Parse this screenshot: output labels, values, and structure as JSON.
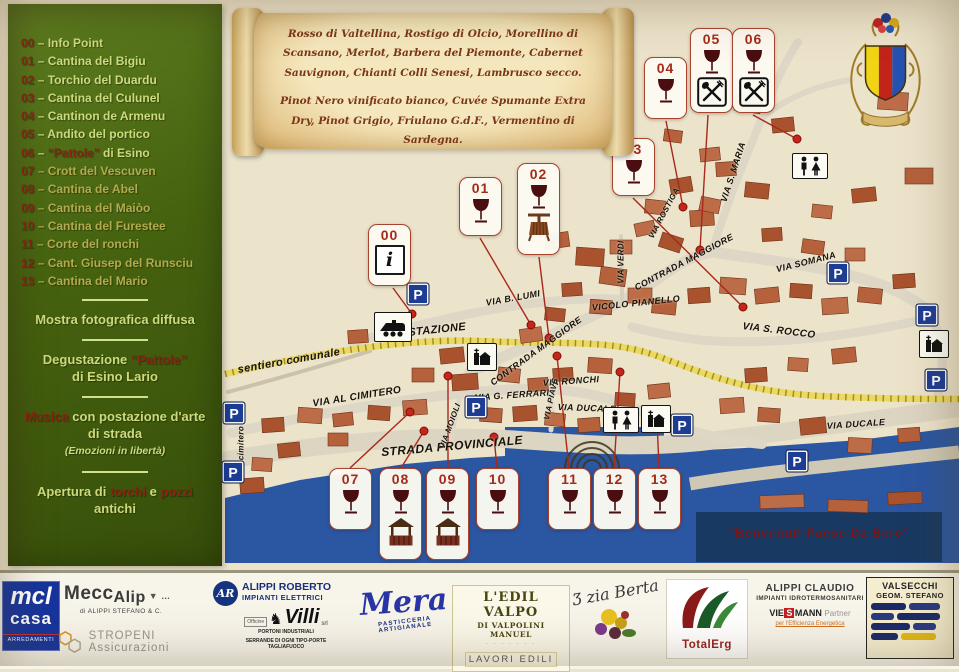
{
  "legend": {
    "sep": "–",
    "items": [
      {
        "num": "00",
        "parts": [
          {
            "t": "Info Point",
            "red": false
          }
        ]
      },
      {
        "num": "01",
        "parts": [
          {
            "t": "Cantina del Bigiu",
            "red": false
          }
        ]
      },
      {
        "num": "02",
        "parts": [
          {
            "t": "Torchio del Duardu",
            "red": false
          }
        ]
      },
      {
        "num": "03",
        "parts": [
          {
            "t": "Cantina del Culunel",
            "red": false
          }
        ]
      },
      {
        "num": "04",
        "parts": [
          {
            "t": "Cantinon de Armenu",
            "red": false
          }
        ]
      },
      {
        "num": "05",
        "parts": [
          {
            "t": "Andito del portico",
            "red": false
          }
        ]
      },
      {
        "num": "06",
        "parts": [
          {
            "t": "“Pattole”",
            "red": true
          },
          {
            "t": " di Esino",
            "red": false
          }
        ]
      },
      {
        "num": "07",
        "parts": [
          {
            "t": "Crott del Vescuven",
            "red": false
          }
        ]
      },
      {
        "num": "08",
        "parts": [
          {
            "t": "Cantina de Abel",
            "red": false
          }
        ]
      },
      {
        "num": "09",
        "parts": [
          {
            "t": "Cantina del Maiòo",
            "red": false
          }
        ]
      },
      {
        "num": "10",
        "parts": [
          {
            "t": "Cantina del Furestee",
            "red": false
          }
        ]
      },
      {
        "num": "11",
        "parts": [
          {
            "t": "Corte del ronchi",
            "red": false
          }
        ]
      },
      {
        "num": "12",
        "parts": [
          {
            "t": "Cant. Giusep del Runsciu",
            "red": false
          }
        ]
      },
      {
        "num": "13",
        "parts": [
          {
            "t": "Cantina del Mario",
            "red": false
          }
        ]
      }
    ],
    "notes": [
      {
        "lines": [
          [
            {
              "t": "Mostra fotografica diffusa",
              "red": false
            }
          ]
        ]
      },
      {
        "lines": [
          [
            {
              "t": "Degustazione ",
              "red": false
            },
            {
              "t": "“Pattole”",
              "red": true
            }
          ],
          [
            {
              "t": "di Esino Lario",
              "red": false
            }
          ]
        ]
      },
      {
        "lines": [
          [
            {
              "t": "Musica",
              "red": true
            },
            {
              "t": " con postazione d'arte",
              "red": false
            }
          ],
          [
            {
              "t": "di strada",
              "red": false
            }
          ]
        ],
        "sub": "(Emozioni in libertà)"
      },
      {
        "lines": [
          [
            {
              "t": "Apertura di ",
              "red": false
            },
            {
              "t": "torchi",
              "red": true
            },
            {
              "t": " e ",
              "red": false
            },
            {
              "t": "pozzi",
              "red": true
            }
          ],
          [
            {
              "t": "antichi",
              "red": false
            }
          ]
        ]
      }
    ]
  },
  "scroll": {
    "para1": "Rosso di Valtellina, Rostigo di Olcio, Morellino di Scansano, Merlot, Barbera del Piemonte, Cabernet Sauvignon, Chianti Colli Senesi, Lambrusco secco.",
    "para2": "Pinot Nero vinificato bianco, Cuvée Spumante Extra Dry, Pinot Grigio, Friulano G.d.F., Vermentino di Sardegna."
  },
  "map": {
    "welcome": "“Benvenuti Paese Da Bere”",
    "parking_label": "P",
    "info_symbol": "i",
    "markers": [
      {
        "num": "00",
        "icon": "info",
        "x": 368,
        "y": 224,
        "h": 62,
        "line": [
          393,
          288,
          412,
          314
        ]
      },
      {
        "num": "01",
        "icon": "wine",
        "x": 459,
        "y": 177,
        "h": 59,
        "line": [
          480,
          238,
          531,
          325
        ]
      },
      {
        "num": "02",
        "icon": "wine",
        "extra": "press",
        "x": 517,
        "y": 163,
        "h": 92,
        "line": [
          539,
          257,
          549,
          338
        ]
      },
      {
        "num": "03",
        "icon": "wine",
        "x": 612,
        "y": 138,
        "h": 58,
        "line": [
          633,
          198,
          743,
          307
        ]
      },
      {
        "num": "04",
        "icon": "wine",
        "x": 644,
        "y": 57,
        "h": 62,
        "line": [
          666,
          121,
          683,
          207
        ]
      },
      {
        "num": "05",
        "icon": "wine",
        "extra": "cutlery",
        "x": 690,
        "y": 28,
        "h": 85,
        "line": [
          708,
          115,
          700,
          250
        ]
      },
      {
        "num": "06",
        "icon": "wine",
        "extra": "cutlery",
        "x": 732,
        "y": 28,
        "h": 85,
        "line": [
          753,
          115,
          797,
          139
        ]
      },
      {
        "num": "07",
        "icon": "wine",
        "x": 329,
        "y": 468,
        "h": 62,
        "line": [
          350,
          468,
          410,
          412
        ]
      },
      {
        "num": "08",
        "icon": "wine",
        "extra": "well",
        "x": 379,
        "y": 468,
        "h": 92,
        "line": [
          401,
          468,
          424,
          431
        ]
      },
      {
        "num": "09",
        "icon": "wine",
        "extra": "well",
        "x": 426,
        "y": 468,
        "h": 92,
        "line": [
          448,
          468,
          448,
          376
        ]
      },
      {
        "num": "10",
        "icon": "wine",
        "x": 476,
        "y": 468,
        "h": 62,
        "line": [
          497,
          468,
          494,
          437
        ]
      },
      {
        "num": "11",
        "icon": "wine",
        "x": 548,
        "y": 468,
        "h": 62,
        "line": [
          569,
          468,
          557,
          356
        ]
      },
      {
        "num": "12",
        "icon": "wine",
        "x": 593,
        "y": 468,
        "h": 62,
        "line": [
          614,
          468,
          620,
          372
        ]
      },
      {
        "num": "13",
        "icon": "wine",
        "x": 638,
        "y": 468,
        "h": 62,
        "line": [
          659,
          468,
          657,
          420
        ]
      }
    ],
    "streets": [
      {
        "t": "VIA STAZIONE",
        "x": 426,
        "y": 331,
        "r": -6,
        "s": 11
      },
      {
        "t": "VIA B. LUMI",
        "x": 513,
        "y": 298,
        "r": -10,
        "s": 9
      },
      {
        "t": "CONTRADA MAGGIORE",
        "x": 536,
        "y": 351,
        "r": -36,
        "s": 9
      },
      {
        "t": "VICOLO PIANELLO",
        "x": 636,
        "y": 303,
        "r": -6,
        "s": 9
      },
      {
        "t": "CONTRADA MAGGIORE",
        "x": 684,
        "y": 262,
        "r": -28,
        "s": 9
      },
      {
        "t": "VIA SOMANA",
        "x": 806,
        "y": 262,
        "r": -14,
        "s": 9
      },
      {
        "t": "VIA S. ROCCO",
        "x": 779,
        "y": 331,
        "r": 7,
        "s": 10
      },
      {
        "t": "VIA VERDI",
        "x": 621,
        "y": 262,
        "r": -90,
        "s": 8
      },
      {
        "t": "VIA ROSTIGA",
        "x": 664,
        "y": 213,
        "r": -62,
        "s": 8
      },
      {
        "t": "VIA S. MARIA",
        "x": 733,
        "y": 172,
        "r": -72,
        "s": 9
      },
      {
        "t": "sentiero comunale",
        "x": 289,
        "y": 361,
        "r": -10,
        "s": 11
      },
      {
        "t": "VIA AL CIMITERO",
        "x": 357,
        "y": 397,
        "r": -9,
        "s": 10
      },
      {
        "t": "cimitero",
        "x": 241,
        "y": 443,
        "r": -90,
        "s": 8
      },
      {
        "t": "STRADA PROVINCIALE",
        "x": 452,
        "y": 446,
        "r": -5,
        "s": 12
      },
      {
        "t": "VIA MOIOLI",
        "x": 450,
        "y": 426,
        "r": -70,
        "s": 8
      },
      {
        "t": "VIA G. FERRARI",
        "x": 512,
        "y": 395,
        "r": -4,
        "s": 9
      },
      {
        "t": "VIA RONCHI",
        "x": 571,
        "y": 381,
        "r": -4,
        "s": 9
      },
      {
        "t": "VIA PIAVE",
        "x": 551,
        "y": 399,
        "r": -78,
        "s": 8
      },
      {
        "t": "VIA DUCALE",
        "x": 587,
        "y": 408,
        "r": 2,
        "s": 9
      },
      {
        "t": "VIA DUCALE",
        "x": 856,
        "y": 424,
        "r": -4,
        "s": 9
      }
    ],
    "parkings": [
      [
        418,
        294
      ],
      [
        234,
        413
      ],
      [
        233,
        472
      ],
      [
        476,
        407
      ],
      [
        838,
        273
      ],
      [
        927,
        315
      ],
      [
        936,
        380
      ],
      [
        797,
        461
      ],
      [
        682,
        425
      ]
    ],
    "pois": [
      {
        "type": "train",
        "x": 393,
        "y": 327
      },
      {
        "type": "church",
        "x": 482,
        "y": 357
      },
      {
        "type": "church",
        "x": 656,
        "y": 419
      },
      {
        "type": "church",
        "x": 934,
        "y": 344
      },
      {
        "type": "wc",
        "x": 810,
        "y": 166
      },
      {
        "type": "wc",
        "x": 621,
        "y": 420
      }
    ]
  },
  "sponsors": {
    "mcl": {
      "l1": "mcl",
      "l2": "casa",
      "l3": "ARREDAMENTI"
    },
    "meccalip": {
      "n1": "Mecc",
      "n2": "Alip",
      "deco": "▼ …",
      "sub": "di ALIPPI STEFANO & C."
    },
    "stropeni": {
      "name": "STROPENI Assicurazioni"
    },
    "alippi_roberto": {
      "logo": "AR",
      "l1": "ALIPPI ROBERTO",
      "l2": "IMPIANTI ELETTRICI"
    },
    "villi": {
      "pre": "Officine",
      "name": "Villi",
      "post": "srl",
      "sub1": "PORTONI INDUSTRIALI",
      "sub2": "SERRANDE DI OGNI TIPO-PORTE TAGLIAFUOCO"
    },
    "mera": {
      "name": "Mera",
      "sub": "PASTICCERIA ARTIGIANALE"
    },
    "edilvalpo": {
      "l1": "L'EDIL VALPO",
      "l2": "DI VALPOLINI MANUEL",
      "dots": "· · · · · · ·",
      "l3": "LAVORI EDILI"
    },
    "ziaberta": {
      "name": "Ʒ zia Berta"
    },
    "totalerg": {
      "name": "TotalErg"
    },
    "alippi_claudio": {
      "l1": "ALIPPI CLAUDIO",
      "l2": "IMPIANTI IDROTERMOSANITARI",
      "v1": "VIE",
      "v2": "S",
      "v3": "MANN",
      "partner": "Partner",
      "slogan": "per l'Efficienza Energetica"
    },
    "valsecchi": {
      "l1": "VALSECCHI",
      "l2": "GEOM. STEFANO"
    }
  }
}
